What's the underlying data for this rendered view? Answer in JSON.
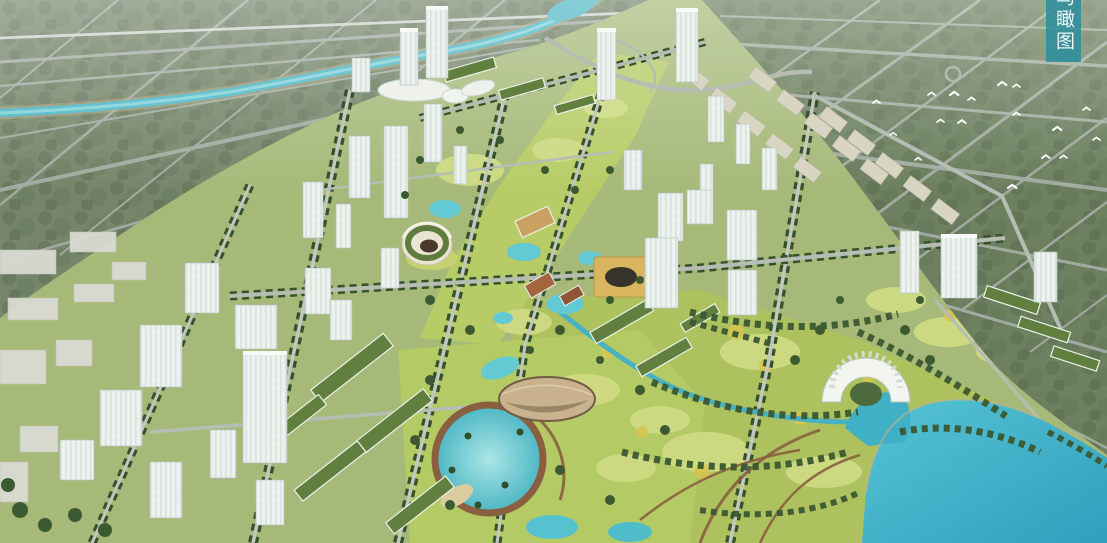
{
  "scene": {
    "description": "Aerial bird's-eye architectural rendering of an eco-city master plan: central park axis with round stadium and ponds, white glass tower clusters, tree-lined avenues, a teal river and southeast lake with a white arch gateway building, surrounded by hazy forest with road grids and a flock of white birds"
  },
  "banner": {
    "text": "鸟瞰图"
  },
  "palette": {
    "forest_nw": "#76866b",
    "forest_ne": "#6d8160",
    "ground": "#a6b979",
    "park": "#b7cc67",
    "park_south": "#b4ca64",
    "park_east": "#adc25f",
    "lawn_light": "#ccd981",
    "flower_yellow": "#d9c54e",
    "road_gray": "#a7b0a8",
    "rail_white": "#d8dcd6",
    "river_teal": "#4db7c6",
    "river_bank": "#b3a47e",
    "creek_teal": "#49b2c2",
    "lake_teal": "#2f9fbd",
    "pond_aqua": "#7fd6da",
    "tree_dark": "#3c5a31",
    "tower_white": "#eef3f0",
    "slab_beige": "#d9d5c3",
    "roof_green": "#61803f",
    "plaza_tan": "#d8b55e",
    "plaza_pond_dark": "#36332b",
    "path_brown": "#8a5f3f",
    "sand_tan": "#c9b28d",
    "stadium_ring_green": "#5f7c3e",
    "arch_white": "#f3f5f0",
    "bird_white": "#ffffff",
    "banner_bg": "#2f8e9c",
    "banner_fg": "#ecf7f6"
  },
  "landmarks": {
    "banner": "vertical title banner",
    "river": "canal river through northwest forest",
    "lake": "southeast lake",
    "arch": "white arch gateway building",
    "stadium": "round stadium",
    "circular_pond": "circular park pond",
    "crater": "sand amphitheater bowl",
    "twin_towers": "landmark twin towers",
    "birds": "flock of white birds"
  }
}
